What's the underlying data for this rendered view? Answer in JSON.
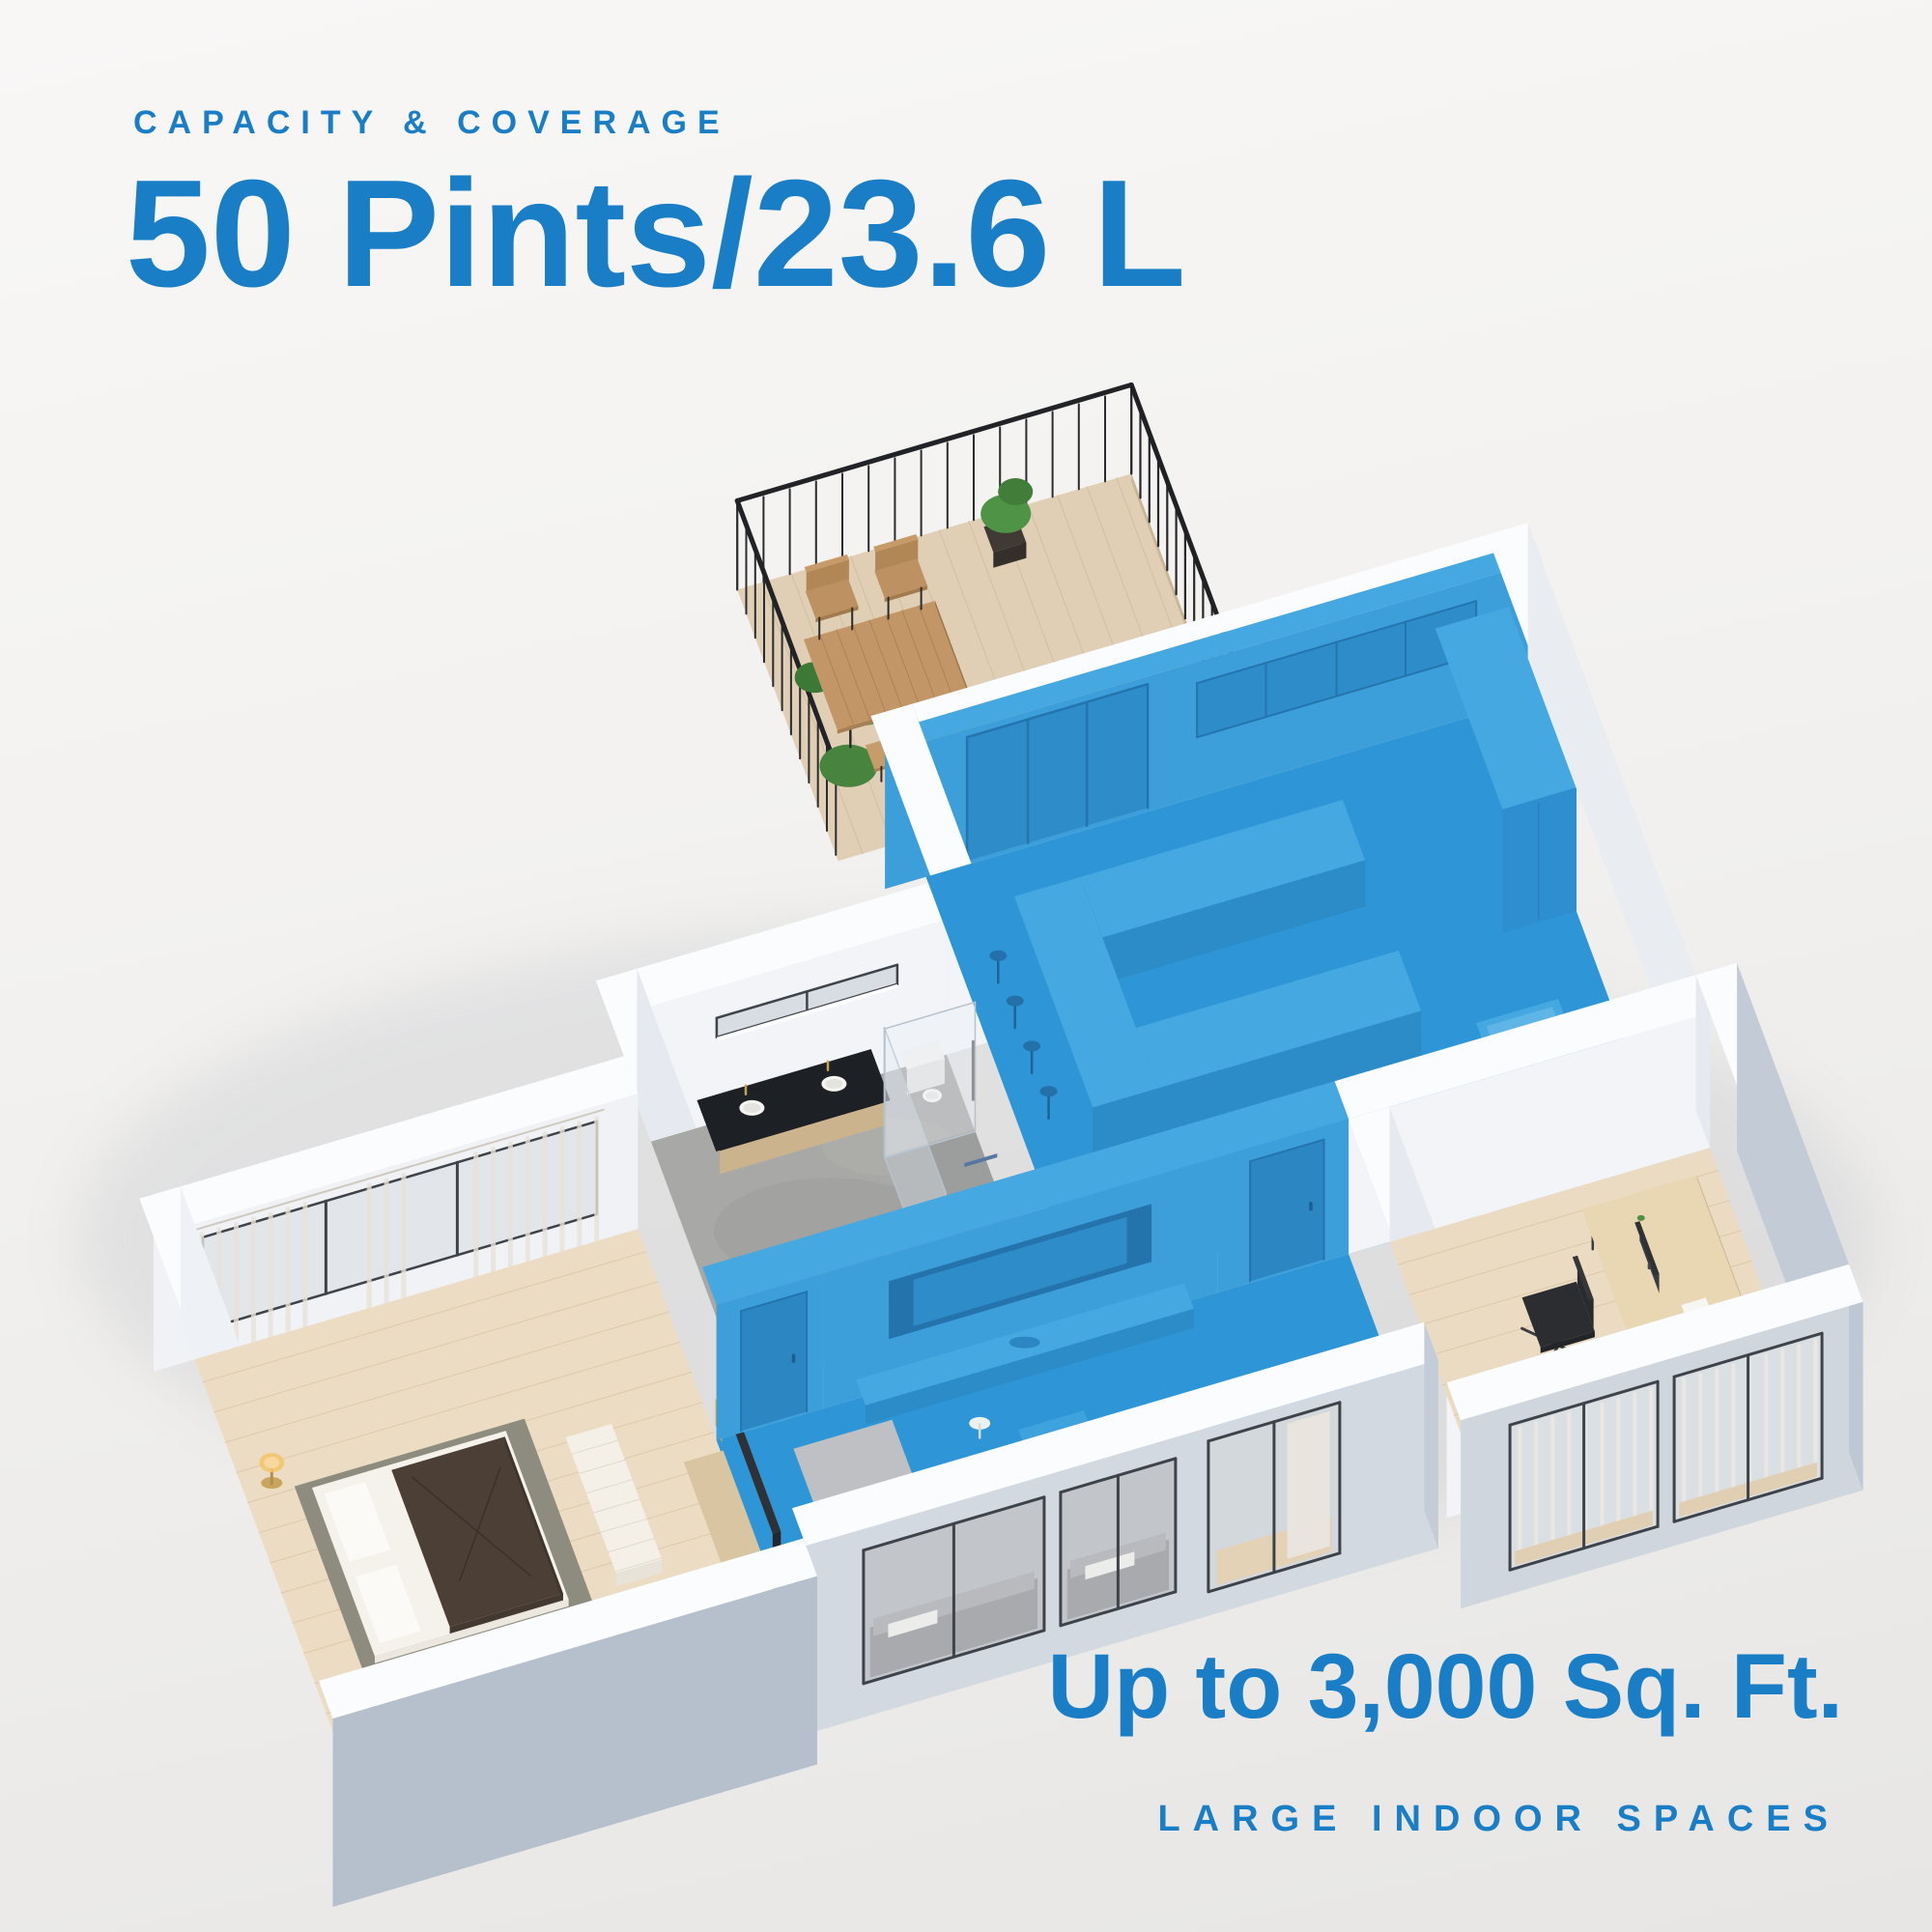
{
  "page": {
    "title": "Capacity & Coverage infographic"
  },
  "header": {
    "eyebrow": "CAPACITY & COVERAGE",
    "headline": "50 Pints/23.6 L"
  },
  "footer": {
    "coverage": "Up to 3,000 Sq. Ft.",
    "caption": "LARGE INDOOR SPACES"
  },
  "colors": {
    "accent": "#1a7ec6",
    "highlight": "#2e96d6",
    "highlight_wall": "#3d9fd9",
    "highlight_dark": "#2579b5",
    "highlight_top": "#45a8e0",
    "background": "#f0efee"
  },
  "floorplan": {
    "type": "isometric-apartment",
    "highlighted_zone": "kitchen-dining-living",
    "rooms": [
      "bedroom",
      "bathroom",
      "kitchen",
      "living-room",
      "office",
      "balcony"
    ]
  }
}
